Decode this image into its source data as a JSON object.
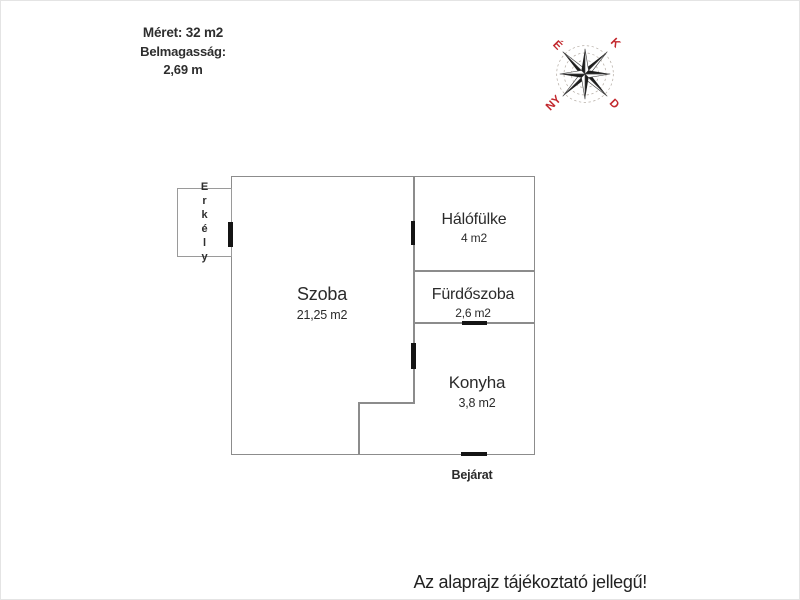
{
  "meta": {
    "size_label": "Méret: 32 m2",
    "ceiling_height_label": "Belmagasság:",
    "ceiling_height_value": "2,69 m"
  },
  "compass": {
    "north": "É",
    "east": "K",
    "south": "D",
    "west": "NY",
    "letter_color": "#c2272d"
  },
  "rooms": [
    {
      "name": "Szoba",
      "area": "21,25 m2"
    },
    {
      "name": "Hálófülke",
      "area": "4 m2"
    },
    {
      "name": "Fürdőszoba",
      "area": "2,6 m2"
    },
    {
      "name": "Konyha",
      "area": "3,8 m2"
    }
  ],
  "balcony": {
    "name": "Erkély"
  },
  "entrance_label": "Bejárat",
  "disclaimer": "Az alaprajz tájékoztató jellegű!",
  "colors": {
    "wall": "#8c8c8c",
    "door": "#141414",
    "text": "#2b2b2b",
    "compass_red": "#c2272d"
  }
}
